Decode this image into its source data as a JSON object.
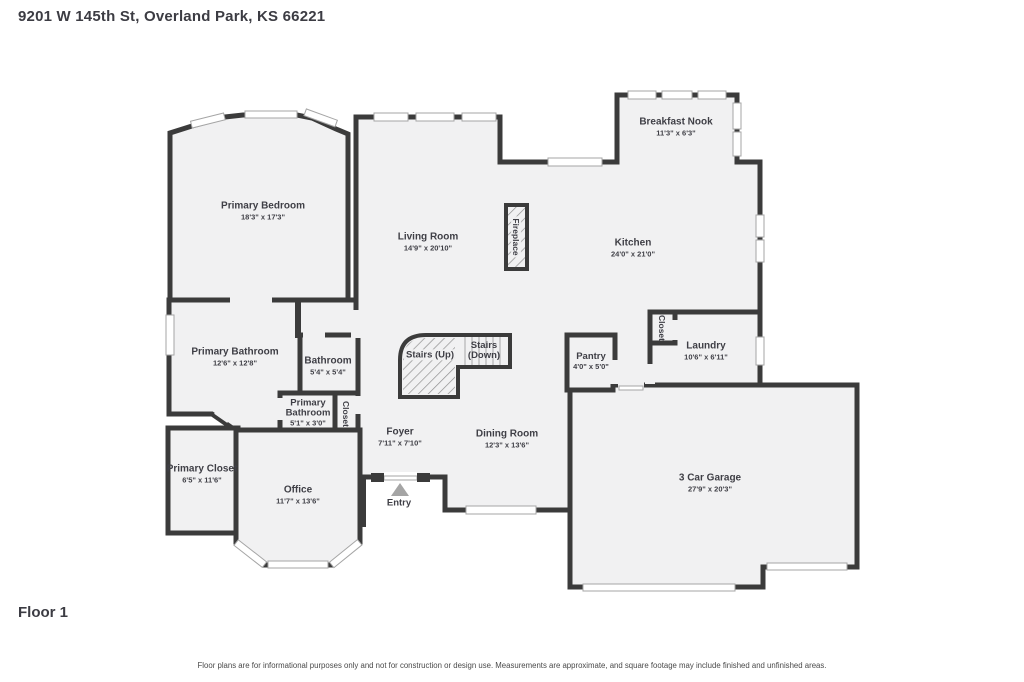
{
  "header": {
    "title": "9201 W 145th St, Overland Park, KS 66221"
  },
  "footer": {
    "floor_label": "Floor 1",
    "disclaimer": "Floor plans are for informational purposes only and not for construction or design use. Measurements are approximate, and square footage may include finished and unfinished areas."
  },
  "colors": {
    "wall": "#3b3b3b",
    "room_fill": "#f1f1f2",
    "window_fill": "#ffffff",
    "window_stroke": "#a5a5a5",
    "text": "#3f3f46",
    "entry_arrow": "#a5a5a5",
    "background": "#ffffff"
  },
  "plan": {
    "rooms": [
      {
        "name": "Primary Bedroom",
        "dims": "18'3\" x 17'3\""
      },
      {
        "name": "Living Room",
        "dims": "14'9\" x 20'10\""
      },
      {
        "name": "Breakfast Nook",
        "dims": "11'3\" x 6'3\""
      },
      {
        "name": "Kitchen",
        "dims": "24'0\" x 21'0\""
      },
      {
        "name": "Primary Bathroom",
        "dims": "12'6\" x 12'8\""
      },
      {
        "name": "Bathroom",
        "dims": "5'4\" x 5'4\""
      },
      {
        "name": "Stairs (Up)",
        "dims": ""
      },
      {
        "name": "Stairs (Down)",
        "dims": ""
      },
      {
        "name": "Pantry",
        "dims": "4'0\" x 5'0\""
      },
      {
        "name": "Laundry",
        "dims": "10'6\" x 6'11\""
      },
      {
        "name": "Closet",
        "dims": ""
      },
      {
        "name": "Primary Bathroom",
        "dims": "5'1\" x 3'0\""
      },
      {
        "name": "Closet",
        "dims": ""
      },
      {
        "name": "Primary Closet",
        "dims": "6'5\" x 11'6\""
      },
      {
        "name": "Office",
        "dims": "11'7\" x 13'6\""
      },
      {
        "name": "Foyer",
        "dims": "7'11\" x 7'10\""
      },
      {
        "name": "Dining Room",
        "dims": "12'3\" x 13'6\""
      },
      {
        "name": "3 Car Garage",
        "dims": "27'9\" x 20'3\""
      },
      {
        "name": "Entry",
        "dims": ""
      },
      {
        "name": "Fireplace",
        "dims": ""
      }
    ]
  }
}
